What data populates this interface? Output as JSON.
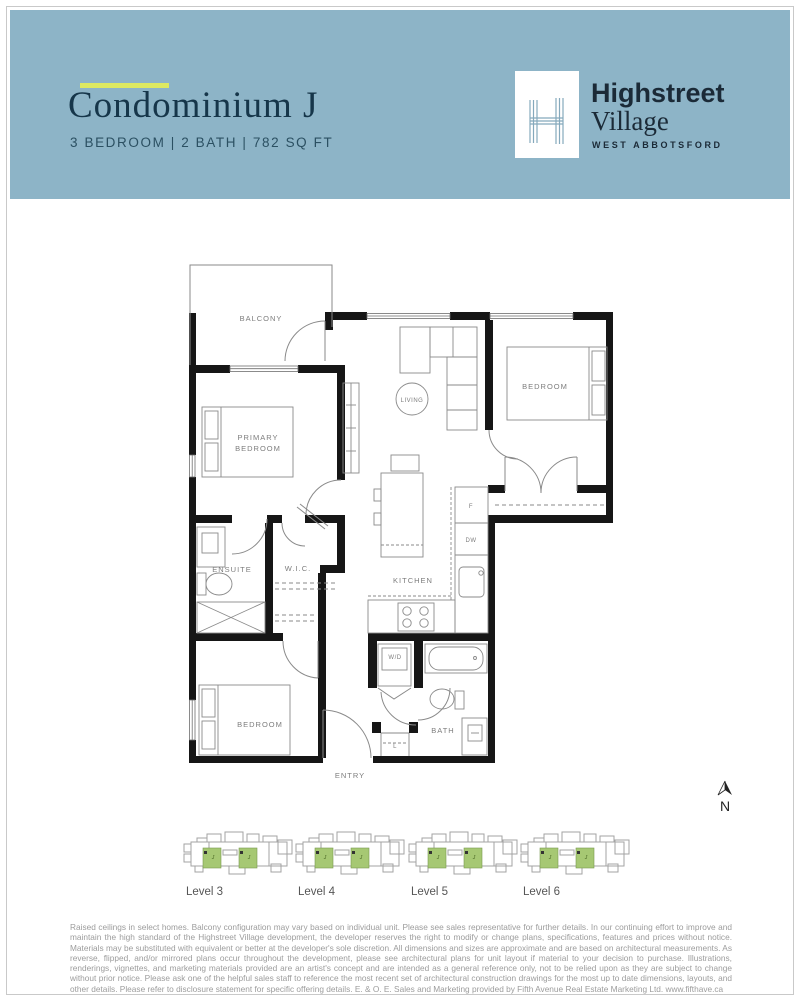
{
  "header": {
    "title": "Condominium J",
    "subtitle": "3 BEDROOM  |  2 BATH  |  782 SQ FT",
    "accent_color": "#dde961",
    "band_color": "#8db4c7",
    "logo": {
      "monogram": "H",
      "brand_line1": "Highstreet",
      "brand_line2": "Village",
      "brand_line3": "WEST ABBOTSFORD"
    }
  },
  "floor_plan": {
    "labels": {
      "balcony": "BALCONY",
      "primary_bedroom_line1": "PRIMARY",
      "primary_bedroom_line2": "BEDROOM",
      "living": "LIVING",
      "bedroom_top": "BEDROOM",
      "ensuite": "ENSUITE",
      "wic": "W.I.C.",
      "kitchen": "KITCHEN",
      "washer_dryer": "W/D",
      "bedroom_bottom": "BEDROOM",
      "bath": "BATH",
      "entry": "ENTRY",
      "fridge": "F",
      "dishwasher": "DW",
      "linen": "L"
    },
    "north_letter": "N",
    "wall_color": "#161616",
    "line_color": "#8a8a8a"
  },
  "levels": {
    "unit_label": "J",
    "unit_color": "#a6c873",
    "items": [
      {
        "label": "Level 3"
      },
      {
        "label": "Level 4"
      },
      {
        "label": "Level 5"
      },
      {
        "label": "Level 6"
      }
    ]
  },
  "disclaimer": "Raised ceilings in select homes. Balcony configuration may vary based on individual unit. Please see sales representative for further details. In our continuing effort to improve and maintain the high standard of the Highstreet Village development, the developer reserves the right to modify or change plans, specifications, features and prices without notice. Materials may be substituted with equivalent or better at the developer's sole discretion. All dimensions and sizes are approximate and are based on architectural measurements. As reverse, flipped, and/or mirrored plans occur throughout the development, please see architectural plans for unit layout if material to your decision to purchase. Illustrations, renderings, vignettes, and marketing materials provided are an artist's concept and are intended as a general reference only, not to be relied upon as they are subject to change without prior notice. Please ask one of the helpful sales staff to reference the most recent set of architectural construction drawings for the most up to date dimensions, layouts, and other details. Please refer to disclosure statement for specific offering details. E. & O. E. Sales and Marketing provided by Fifth Avenue Real Estate Marketing Ltd. www.fifthave.ca"
}
